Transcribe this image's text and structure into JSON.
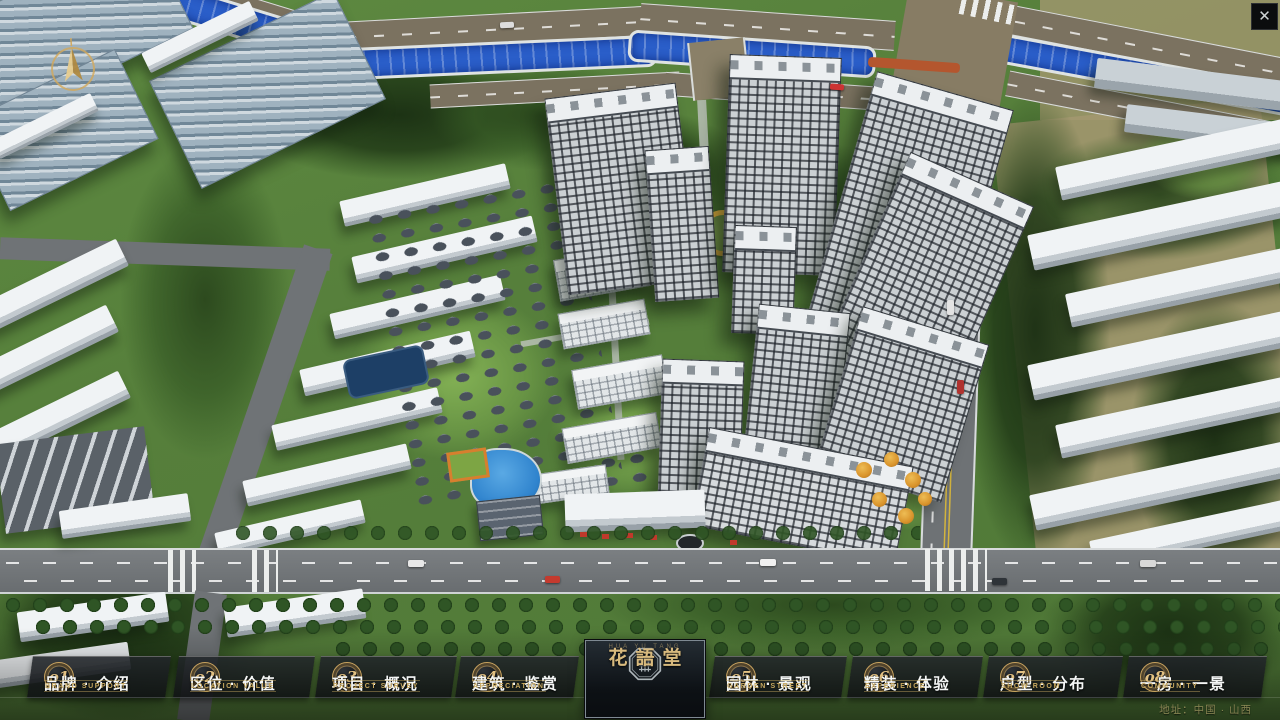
{
  "icons": {
    "close": "✕"
  },
  "nav": {
    "items": [
      {
        "num": "o1",
        "zh": "品牌 · 介绍",
        "en": "BRAND SUPPORT"
      },
      {
        "num": "o2",
        "zh": "区位 · 价值",
        "en": "LOCATION VALUE"
      },
      {
        "num": "o3",
        "zh": "项目 · 概况",
        "en": "PROJECT SURVEY"
      },
      {
        "num": "o4",
        "zh": "建筑 · 鉴赏",
        "en": "APPRECIATION"
      },
      {
        "num": "o5",
        "zh": "园林 · 景观",
        "en": "GARDEN STREET"
      },
      {
        "num": "o6",
        "zh": "精装 · 体验",
        "en": "EXPERIENCE"
      },
      {
        "num": "o7",
        "zh": "户型 · 分布",
        "en": "SHOW ROOM"
      },
      {
        "num": "o8",
        "zh": "一房 · 一景",
        "en": "COMMUNITY"
      }
    ]
  },
  "logo": {
    "title": "花語堂",
    "subtitle": "HUA YU TANG"
  },
  "footer": {
    "address": "地址：中国 · 山西"
  }
}
